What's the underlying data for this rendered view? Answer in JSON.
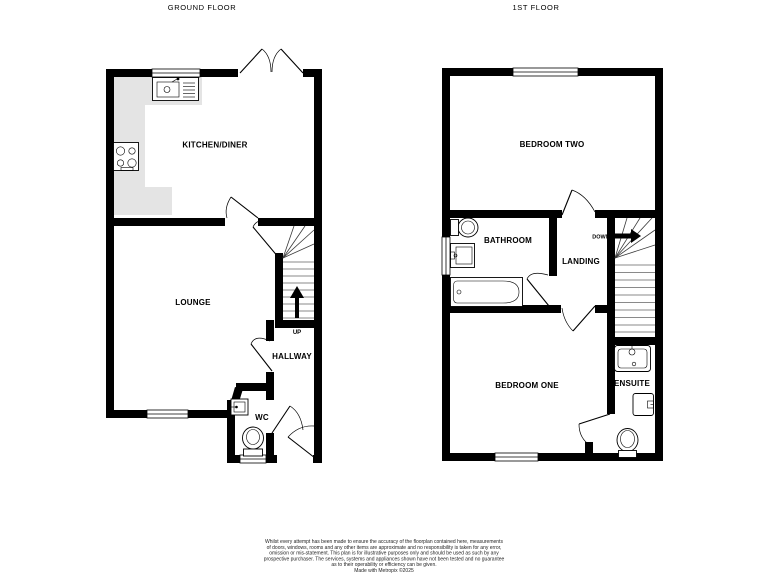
{
  "titles": {
    "ground_floor": "GROUND FLOOR",
    "first_floor": "1ST FLOOR"
  },
  "ground_floor": {
    "rooms": {
      "kitchen_diner": "KITCHEN/DINER",
      "lounge": "LOUNGE",
      "hallway": "HALLWAY",
      "wc": "WC"
    },
    "stair_direction": "UP"
  },
  "first_floor": {
    "rooms": {
      "bedroom_two": "BEDROOM TWO",
      "bathroom": "BATHROOM",
      "landing": "LANDING",
      "bedroom_one": "BEDROOM ONE",
      "ensuite": "ENSUITE"
    },
    "stair_direction": "DOWN"
  },
  "disclaimer": {
    "lines": [
      "Whilst every attempt has been made to ensure the accuracy of the floorplan contained here, measurements",
      "of doors, windows, rooms and any other items are approximate and no responsibility is taken for any error,",
      "omission or mis-statement. This plan is for illustrative purposes only and should be used as such by any",
      "prospective purchaser. The services, systems and appliances shown have not been tested and no guarantee",
      "as to their operability or efficiency can be given.",
      "Made with Metropix ©2025"
    ]
  },
  "colors": {
    "wall": "#000000",
    "counter": "#e4e4e4",
    "background": "#ffffff",
    "tread_line": "#8a8a8a"
  }
}
